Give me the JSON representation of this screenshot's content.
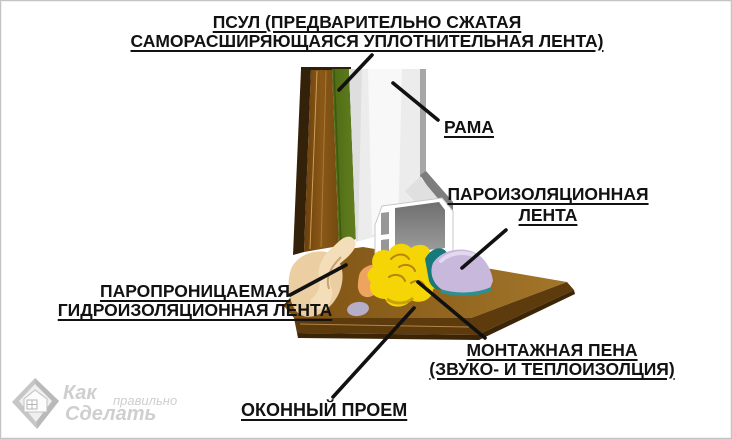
{
  "figure": {
    "title_line1": "ПСУЛ (ПРЕДВАРИТЕЛЬНО СЖАТАЯ",
    "title_line2": "САМОРАСШИРЯЮЩАЯСЯ УПЛОТНИТЕЛЬНАЯ ЛЕНТА)",
    "labels": {
      "frame": "РАМА",
      "vapor_tape_line1": "ПАРОИЗОЛЯЦИОННАЯ",
      "vapor_tape_line2": "ЛЕНТА",
      "waterproof_tape_line1": "ПАРОПРОНИЦАЕМАЯ",
      "waterproof_tape_line2": "ГИДРОИЗОЛЯЦИОННАЯ ЛЕНТА",
      "foam_line1": "МОНТАЖНАЯ ПЕНА",
      "foam_line2": "(ЗВУКО- И ТЕПЛОИЗОЛЦИЯ)",
      "opening": "ОКОННЫЙ ПРОЕМ"
    }
  },
  "watermark": {
    "word1": "Как",
    "word2": "правильно",
    "word3": "Сделать"
  },
  "colors": {
    "wood_brown": "#7c4e12",
    "wood_dark_edge": "#33210a",
    "sill_brown_top": "#8a5a16",
    "sill_brown_front": "#5e3b0c",
    "psul_green": "#55741c",
    "frame_white": "#ececec",
    "frame_gray_edge": "#7d7d7d",
    "foam_yellow": "#f6d506",
    "foam_orange": "#eda45e",
    "vapor_tape_purple": "#c8b8dc",
    "sealant_teal": "#17797a",
    "waterproof_beige": "#ebcfa2",
    "annotation_line": "#111111",
    "watermark_gray": "#cfcfcf"
  }
}
